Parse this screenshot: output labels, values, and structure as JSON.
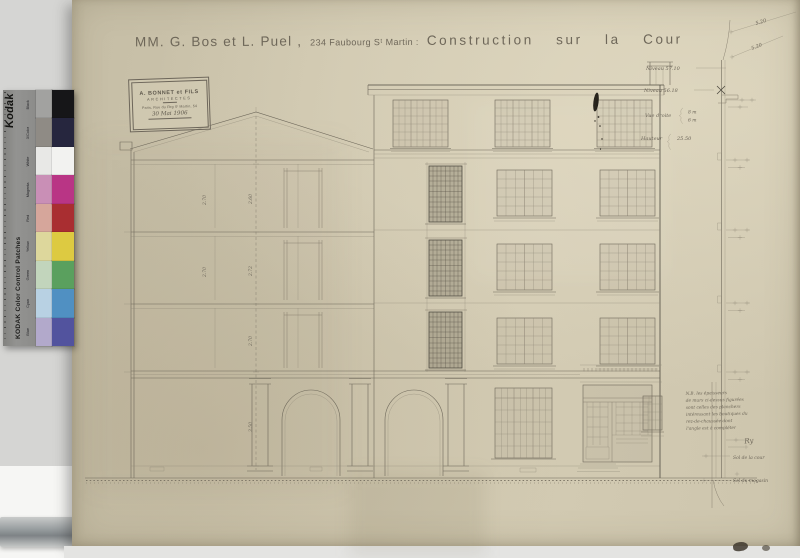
{
  "scan": {
    "background": "#d5d5d3",
    "paper": "#cfc7af"
  },
  "title": {
    "part1": "MM. G. Bos et L. Puel ,",
    "part2": "234 Faubourg Sᵗ Martin :",
    "part3": "Construction sur la Cour"
  },
  "stamp": {
    "name": "A. BONNET et FILS",
    "role": "ARCHITECTES",
    "address": "Paris, Rue du Fbg Sᵗ Martin, 54",
    "date": "30 Mai 1906"
  },
  "kodak": {
    "brand": "Kodak",
    "label": "KODAK Color Control Patches",
    "patches": [
      {
        "name": "Black",
        "light": "#a2a2a0",
        "full": "#161618"
      },
      {
        "name": "3/Color",
        "light": "#8f8b85",
        "full": "#26263e"
      },
      {
        "name": "White",
        "light": "#e8e8e6",
        "full": "#f2f2f0"
      },
      {
        "name": "Magenta",
        "light": "#c98fb6",
        "full": "#b93585"
      },
      {
        "name": "Red",
        "light": "#d6a69b",
        "full": "#a92e31"
      },
      {
        "name": "Yellow",
        "light": "#ddd79c",
        "full": "#ddca41"
      },
      {
        "name": "Green",
        "light": "#c2d5bc",
        "full": "#5aa05e"
      },
      {
        "name": "Cyan",
        "light": "#b8d1e3",
        "full": "#5090c2"
      },
      {
        "name": "Blue",
        "light": "#b2a9cb",
        "full": "#52539e"
      }
    ]
  },
  "dims": {
    "section": [
      "2.60",
      "2.72",
      "2.70",
      "3.50"
    ],
    "left": [
      "2.70",
      "2.70"
    ],
    "diag1": "5.20",
    "diag2": "5.20"
  },
  "annotations": {
    "level1": "Niveau 57.10",
    "level2": "Niveau 56.18",
    "vue_label": "Vue droite",
    "vue_top": "8 m",
    "vue_bottom": "6 m",
    "h_label": "Hauteur",
    "h_value": "25.50",
    "sol_cour": "Sol de la cour",
    "sol_magasin": "Sol du magasin"
  },
  "note": {
    "lines": [
      "N.B. les épaisseurs",
      "de murs ci-dessus figurées",
      "sont celles des planchers",
      "intéressant les boutiques du",
      "rez-de-chaussée dont",
      "l'angle est à compléter"
    ],
    "signature": "Ry"
  }
}
